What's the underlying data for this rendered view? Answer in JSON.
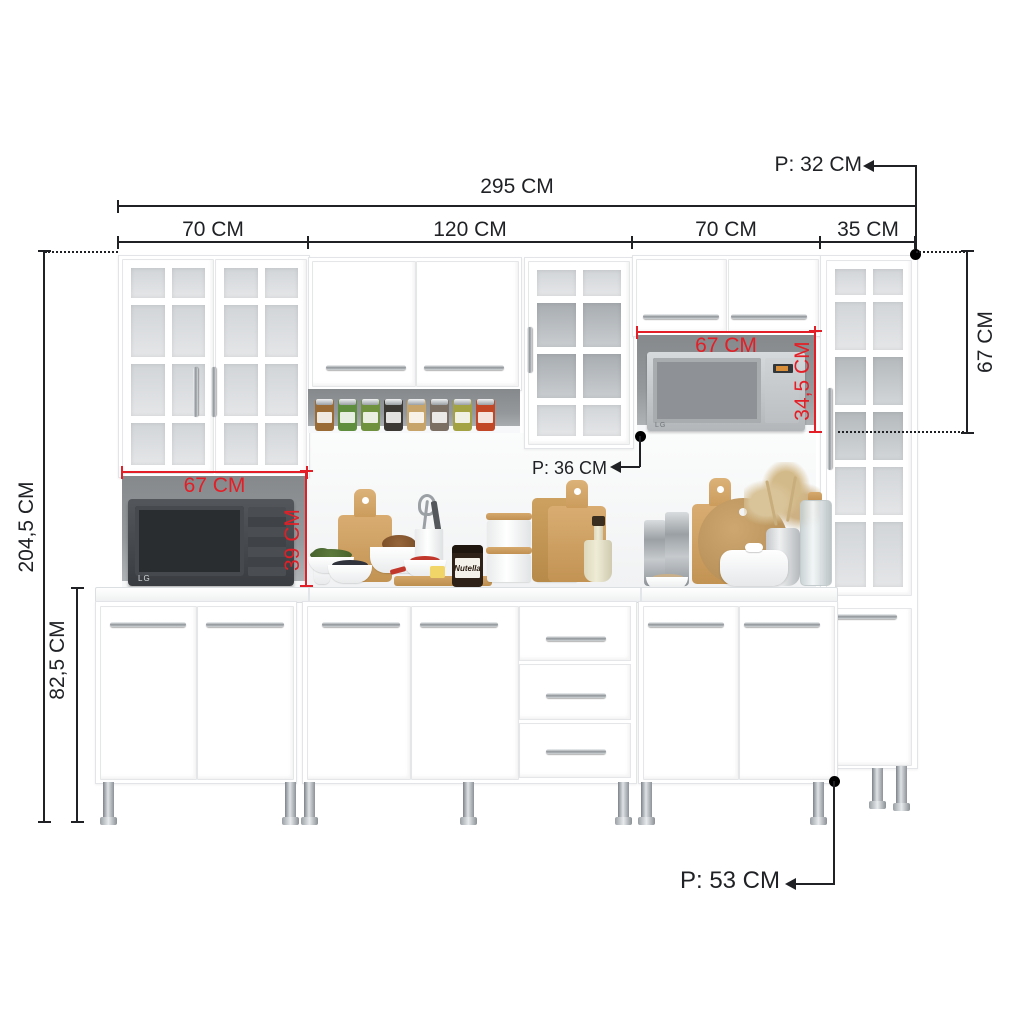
{
  "annotations": {
    "wall_depth": "P: 32 CM",
    "total_width": "295 CM",
    "section_widths": [
      "70 CM",
      "120 CM",
      "70 CM",
      "35 CM"
    ],
    "total_height": "204,5 CM",
    "base_unit_height": "82,5 CM",
    "left_niche_width": "67 CM",
    "left_niche_height": "39 CM",
    "right_niche_width": "67 CM",
    "right_niche_height": "34,5 CM",
    "mid_depth": "P: 36 CM",
    "upper_right_cabinet_height": "67 CM",
    "base_depth": "P: 53 CM"
  },
  "scene": {
    "microwave_left_brand": "LG",
    "microwave_right_brand": "LG",
    "nutella_jar_label": "Nutella",
    "spice_jars": [
      "#9a6b35",
      "#5f8f3e",
      "#70923f",
      "#3c3833",
      "#c7a469",
      "#7b6f63",
      "#a3a344",
      "#c14727"
    ]
  },
  "theme": {
    "ink": "#1f2124",
    "red": "#e41e26",
    "cabinet": "#ffffff",
    "edge": "#e2e4e7",
    "niche": "#94989b",
    "wood": "#cfa165"
  }
}
